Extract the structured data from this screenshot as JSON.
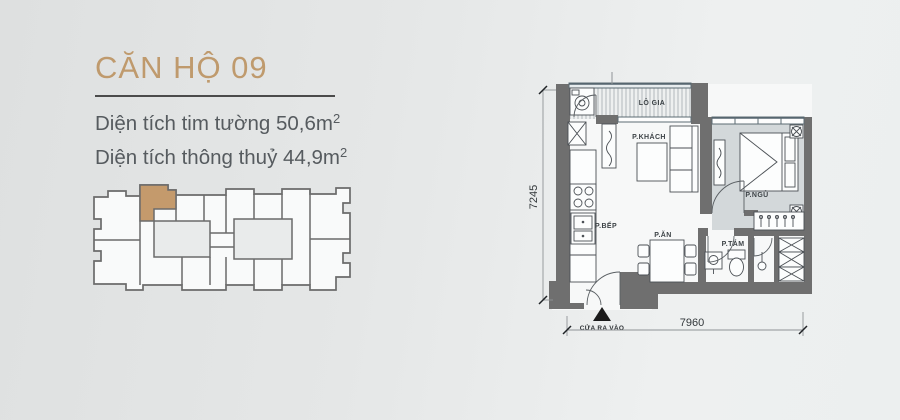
{
  "header": {
    "title": "CĂN HỘ 09",
    "accent_color": "#bf9a6d",
    "underline_color": "#4b4b4b",
    "area_lines": [
      {
        "text": "Diện tích tim tường 50,6m",
        "sup": "2"
      },
      {
        "text": "Diện tích thông thuỷ 44,9m",
        "sup": "2"
      }
    ]
  },
  "keyplan": {
    "highlight_color": "#c49a6c",
    "wall_color": "#6b6b6b",
    "unit_fill": "#f9fafa",
    "core_fill": "#e9ebeb"
  },
  "floorplan": {
    "rooms": {
      "logia": "LÔ GIA",
      "khach": "P.KHÁCH",
      "ngu": "P.NGỦ",
      "bep": "P.BẾP",
      "an": "P.ĂN",
      "tam": "P.TẮM"
    },
    "entrance_label": "CỬA RA VÀO",
    "dim_width": "7960",
    "dim_height": "7245",
    "wall_color": "#6f6f6f",
    "bedroom_floor_color": "#d3d8da",
    "floor_color": "#f7f8f8"
  }
}
